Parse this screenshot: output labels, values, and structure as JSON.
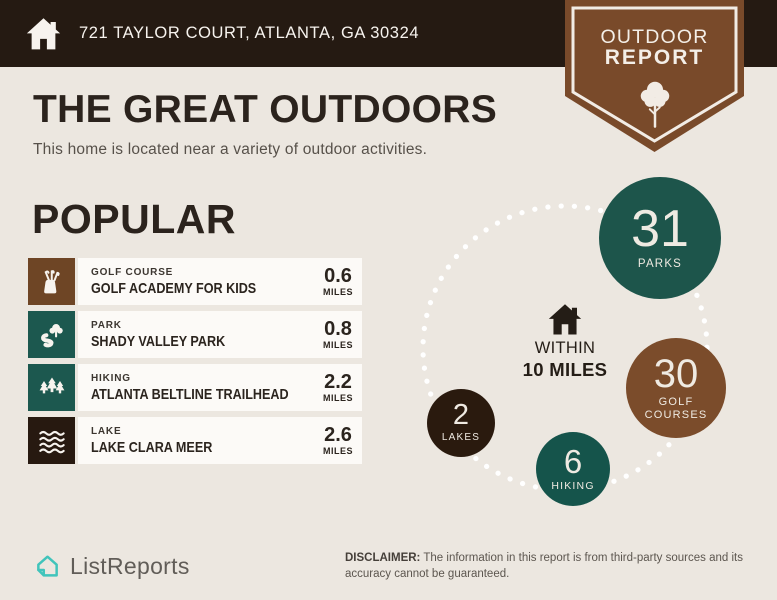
{
  "header": {
    "address": "721 TAYLOR COURT, ATLANTA, GA 30324"
  },
  "badge": {
    "line1": "OUTDOOR",
    "line2": "REPORT"
  },
  "main": {
    "title": "THE GREAT OUTDOORS",
    "subtitle": "This home is located near a variety of outdoor activities.",
    "section_title": "POPULAR",
    "items": [
      {
        "category": "GOLF COURSE",
        "name": "GOLF ACADEMY FOR KIDS",
        "distance": "0.6",
        "unit": "MILES",
        "icon": "golf-bag-icon",
        "color": "#6e4525"
      },
      {
        "category": "PARK",
        "name": "SHADY VALLEY PARK",
        "distance": "0.8",
        "unit": "MILES",
        "icon": "park-tree-icon",
        "color": "#1c584f"
      },
      {
        "category": "HIKING",
        "name": "ATLANTA BELTLINE TRAILHEAD",
        "distance": "2.2",
        "unit": "MILES",
        "icon": "pine-trees-icon",
        "color": "#1c584f"
      },
      {
        "category": "LAKE",
        "name": "LAKE CLARA MEER",
        "distance": "2.6",
        "unit": "MILES",
        "icon": "waves-icon",
        "color": "#271910"
      }
    ]
  },
  "stats": {
    "center": {
      "line1": "WITHIN",
      "line2": "10 MILES"
    },
    "bubbles": [
      {
        "value": "31",
        "label": "PARKS",
        "color": "#1d554b"
      },
      {
        "value": "30",
        "label": "GOLF COURSES",
        "color": "#7b4c2b"
      },
      {
        "value": "2",
        "label": "LAKES",
        "color": "#2a1a0e"
      },
      {
        "value": "6",
        "label": "HIKING",
        "color": "#15544b"
      }
    ]
  },
  "footer": {
    "brand": "ListReports",
    "disclaimer_label": "DISCLAIMER:",
    "disclaimer_text": " The information in this report is from third-party sources and its accuracy cannot be guaranteed."
  },
  "colors": {
    "header_bar": "#251a12",
    "background": "#ece7e0",
    "badge_brown": "#794a2a",
    "teal_dark": "#1d554b",
    "brown": "#7b4c2b",
    "dark_brown": "#2a1a0e",
    "row_panel": "#fcfaf7",
    "brand_teal": "#41c4bb"
  }
}
